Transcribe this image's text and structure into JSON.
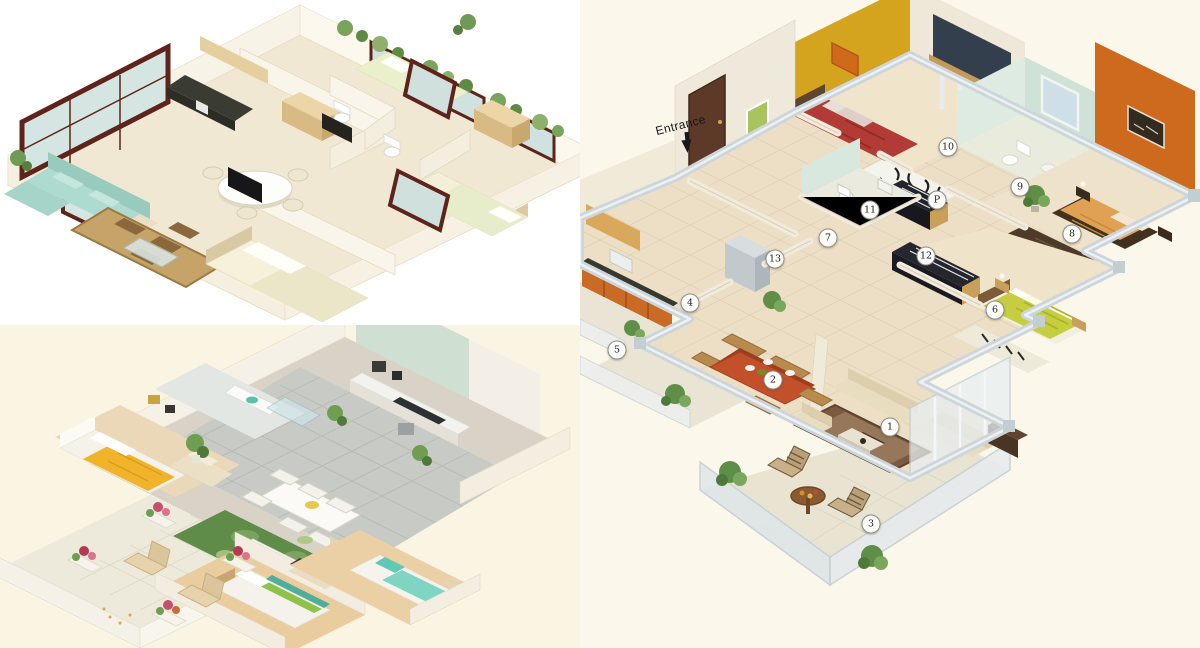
{
  "palette": {
    "page_bg": "#ffffff",
    "panel_tl_bg": "#ffffff",
    "panel_bl_bg": "#faf5e2",
    "panel_r_bg": "#fbf7ea",
    "cream_floor": "#ecdfc5",
    "teal_sofa": "#aedbd0",
    "window_frame_red": "#5e241b",
    "yellow_wall": "#d4a41f",
    "orange_wall": "#cd6a1e",
    "red_bed": "#b23b35",
    "orange_bed": "#e0a252",
    "green_bed": "#c6cd3f",
    "yellow_blanket": "#f0b32a",
    "mint_wall": "#cfe0d2",
    "green_rug": "#5f8c48",
    "gray_tile": "#c8cbc5",
    "dining_table_red": "#c2512b"
  },
  "plans": {
    "right": {
      "entrance_label": "Entrance",
      "markers": [
        {
          "label": "1",
          "x": 310,
          "y": 427
        },
        {
          "label": "2",
          "x": 193,
          "y": 380
        },
        {
          "label": "3",
          "x": 291,
          "y": 524
        },
        {
          "label": "4",
          "x": 110,
          "y": 303
        },
        {
          "label": "5",
          "x": 37,
          "y": 350
        },
        {
          "label": "6",
          "x": 415,
          "y": 310
        },
        {
          "label": "7",
          "x": 248,
          "y": 238
        },
        {
          "label": "8",
          "x": 492,
          "y": 234
        },
        {
          "label": "9",
          "x": 440,
          "y": 187
        },
        {
          "label": "10",
          "x": 368,
          "y": 147
        },
        {
          "label": "11",
          "x": 290,
          "y": 210
        },
        {
          "label": "12",
          "x": 346,
          "y": 256
        },
        {
          "label": "13",
          "x": 195,
          "y": 259
        },
        {
          "label": "P",
          "x": 357,
          "y": 200
        }
      ]
    }
  }
}
